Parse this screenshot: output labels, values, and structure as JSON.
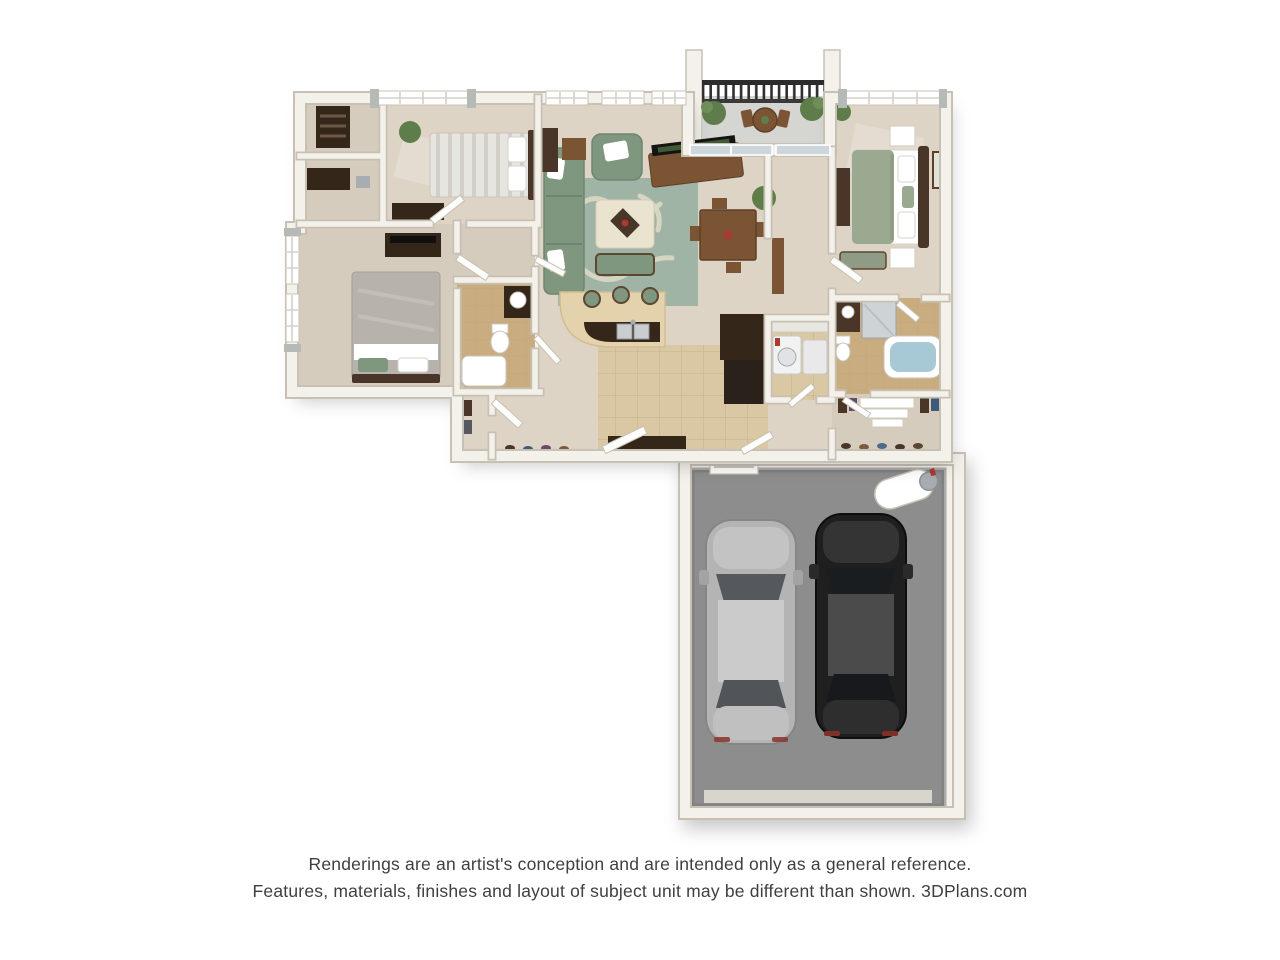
{
  "disclaimer": {
    "line1": "Renderings are an artist's conception and are intended only as a general reference.",
    "line2": "Features, materials, finishes and layout of subject unit may be different than shown. 3DPlans.com"
  },
  "colors": {
    "bg": "#ffffff",
    "wall": "#f4f1ea",
    "wall_edge": "#c7c1b5",
    "carpet": "#ded4c5",
    "carpet_dark": "#d6ccbd",
    "tile_kitchen": "#d9c8a3",
    "tile_bath": "#c9ad80",
    "tile_line": "#bca275",
    "garage_floor": "#8d8d8d",
    "balcony_floor": "#d5d5d2",
    "rug": "#9fb4a4",
    "rug_swirl": "#dcd8c4",
    "sofa_green": "#7f977f",
    "duvet_sage": "#9aa98f",
    "wood": "#7b5434",
    "wood_dark": "#4a3628",
    "dark_furniture": "#342619",
    "glass": "#ccd7db",
    "water": "#a7c9d6",
    "plant": "#5e7d4a",
    "curtain": "#b6bab6",
    "car_silver": "#b4b4b4",
    "car_black": "#1f1f1f",
    "metal": "#a7adb1",
    "accent_red": "#a93a30",
    "text": "#3f3f3f"
  }
}
